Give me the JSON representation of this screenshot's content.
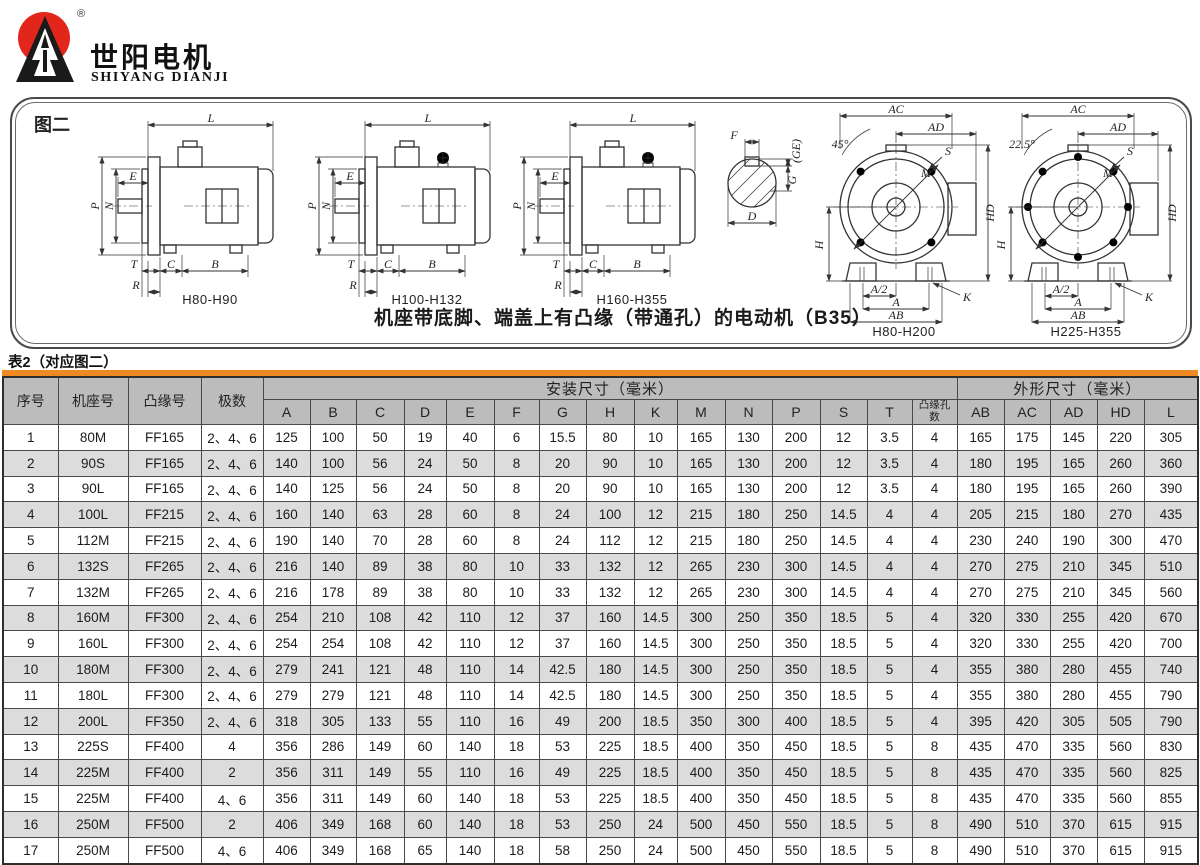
{
  "logo": {
    "brand_cn": "世阳电机",
    "brand_en": "SHIYANG DIANJI",
    "registered": "®"
  },
  "figure": {
    "label": "图二",
    "caption": "机座带底脚、端盖上有凸缘（带通孔）的电动机（B35）",
    "side_dims": {
      "L": "L",
      "E": "E",
      "P": "P",
      "N": "N",
      "T": "T",
      "R": "R",
      "C": "C",
      "B": "B"
    },
    "shaft_dims": {
      "F": "F",
      "GE": "(GE)",
      "G": "G",
      "D": "D"
    },
    "front_dims": {
      "AC": "AC",
      "AD": "AD",
      "HD": "HD",
      "H": "H",
      "A2": "A/2",
      "A": "A",
      "AB": "AB",
      "K": "K",
      "M": "M",
      "S": "S"
    },
    "angle_45": "45°",
    "angle_225": "22.5°",
    "captions": {
      "side1": "H80-H90",
      "side2": "H100-H132",
      "side3": "H160-H355",
      "front1": "H80-H200",
      "front2": "H225-H355"
    }
  },
  "colors": {
    "accent_orange": "#ee8a24",
    "header_gray": "#bcbcbc",
    "stripe_gray": "#dcdcdc",
    "logo_red": "#e2261c"
  },
  "table": {
    "title": "表2（对应图二）",
    "header": {
      "col_seq": "序号",
      "col_frame": "机座号",
      "col_flange": "凸缘号",
      "col_poles": "极数",
      "group_mount": "安装尺寸（毫米）",
      "group_outline": "外形尺寸（毫米）",
      "mount_cols": [
        "A",
        "B",
        "C",
        "D",
        "E",
        "F",
        "G",
        "H",
        "K",
        "M",
        "N",
        "P",
        "S",
        "T",
        "凸缘孔数"
      ],
      "outline_cols": [
        "AB",
        "AC",
        "AD",
        "HD",
        "L"
      ]
    },
    "rows": [
      [
        "1",
        "80M",
        "FF165",
        "2、4、6",
        "125",
        "100",
        "50",
        "19",
        "40",
        "6",
        "15.5",
        "80",
        "10",
        "165",
        "130",
        "200",
        "12",
        "3.5",
        "4",
        "165",
        "175",
        "145",
        "220",
        "305"
      ],
      [
        "2",
        "90S",
        "FF165",
        "2、4、6",
        "140",
        "100",
        "56",
        "24",
        "50",
        "8",
        "20",
        "90",
        "10",
        "165",
        "130",
        "200",
        "12",
        "3.5",
        "4",
        "180",
        "195",
        "165",
        "260",
        "360"
      ],
      [
        "3",
        "90L",
        "FF165",
        "2、4、6",
        "140",
        "125",
        "56",
        "24",
        "50",
        "8",
        "20",
        "90",
        "10",
        "165",
        "130",
        "200",
        "12",
        "3.5",
        "4",
        "180",
        "195",
        "165",
        "260",
        "390"
      ],
      [
        "4",
        "100L",
        "FF215",
        "2、4、6",
        "160",
        "140",
        "63",
        "28",
        "60",
        "8",
        "24",
        "100",
        "12",
        "215",
        "180",
        "250",
        "14.5",
        "4",
        "4",
        "205",
        "215",
        "180",
        "270",
        "435"
      ],
      [
        "5",
        "112M",
        "FF215",
        "2、4、6",
        "190",
        "140",
        "70",
        "28",
        "60",
        "8",
        "24",
        "112",
        "12",
        "215",
        "180",
        "250",
        "14.5",
        "4",
        "4",
        "230",
        "240",
        "190",
        "300",
        "470"
      ],
      [
        "6",
        "132S",
        "FF265",
        "2、4、6",
        "216",
        "140",
        "89",
        "38",
        "80",
        "10",
        "33",
        "132",
        "12",
        "265",
        "230",
        "300",
        "14.5",
        "4",
        "4",
        "270",
        "275",
        "210",
        "345",
        "510"
      ],
      [
        "7",
        "132M",
        "FF265",
        "2、4、6",
        "216",
        "178",
        "89",
        "38",
        "80",
        "10",
        "33",
        "132",
        "12",
        "265",
        "230",
        "300",
        "14.5",
        "4",
        "4",
        "270",
        "275",
        "210",
        "345",
        "560"
      ],
      [
        "8",
        "160M",
        "FF300",
        "2、4、6",
        "254",
        "210",
        "108",
        "42",
        "110",
        "12",
        "37",
        "160",
        "14.5",
        "300",
        "250",
        "350",
        "18.5",
        "5",
        "4",
        "320",
        "330",
        "255",
        "420",
        "670"
      ],
      [
        "9",
        "160L",
        "FF300",
        "2、4、6",
        "254",
        "254",
        "108",
        "42",
        "110",
        "12",
        "37",
        "160",
        "14.5",
        "300",
        "250",
        "350",
        "18.5",
        "5",
        "4",
        "320",
        "330",
        "255",
        "420",
        "700"
      ],
      [
        "10",
        "180M",
        "FF300",
        "2、4、6",
        "279",
        "241",
        "121",
        "48",
        "110",
        "14",
        "42.5",
        "180",
        "14.5",
        "300",
        "250",
        "350",
        "18.5",
        "5",
        "4",
        "355",
        "380",
        "280",
        "455",
        "740"
      ],
      [
        "11",
        "180L",
        "FF300",
        "2、4、6",
        "279",
        "279",
        "121",
        "48",
        "110",
        "14",
        "42.5",
        "180",
        "14.5",
        "300",
        "250",
        "350",
        "18.5",
        "5",
        "4",
        "355",
        "380",
        "280",
        "455",
        "790"
      ],
      [
        "12",
        "200L",
        "FF350",
        "2、4、6",
        "318",
        "305",
        "133",
        "55",
        "110",
        "16",
        "49",
        "200",
        "18.5",
        "350",
        "300",
        "400",
        "18.5",
        "5",
        "4",
        "395",
        "420",
        "305",
        "505",
        "790"
      ],
      [
        "13",
        "225S",
        "FF400",
        "4",
        "356",
        "286",
        "149",
        "60",
        "140",
        "18",
        "53",
        "225",
        "18.5",
        "400",
        "350",
        "450",
        "18.5",
        "5",
        "8",
        "435",
        "470",
        "335",
        "560",
        "830"
      ],
      [
        "14",
        "225M",
        "FF400",
        "2",
        "356",
        "311",
        "149",
        "55",
        "110",
        "16",
        "49",
        "225",
        "18.5",
        "400",
        "350",
        "450",
        "18.5",
        "5",
        "8",
        "435",
        "470",
        "335",
        "560",
        "825"
      ],
      [
        "15",
        "225M",
        "FF400",
        "4、6",
        "356",
        "311",
        "149",
        "60",
        "140",
        "18",
        "53",
        "225",
        "18.5",
        "400",
        "350",
        "450",
        "18.5",
        "5",
        "8",
        "435",
        "470",
        "335",
        "560",
        "855"
      ],
      [
        "16",
        "250M",
        "FF500",
        "2",
        "406",
        "349",
        "168",
        "60",
        "140",
        "18",
        "53",
        "250",
        "24",
        "500",
        "450",
        "550",
        "18.5",
        "5",
        "8",
        "490",
        "510",
        "370",
        "615",
        "915"
      ],
      [
        "17",
        "250M",
        "FF500",
        "4、6",
        "406",
        "349",
        "168",
        "65",
        "140",
        "18",
        "58",
        "250",
        "24",
        "500",
        "450",
        "550",
        "18.5",
        "5",
        "8",
        "490",
        "510",
        "370",
        "615",
        "915"
      ]
    ]
  }
}
